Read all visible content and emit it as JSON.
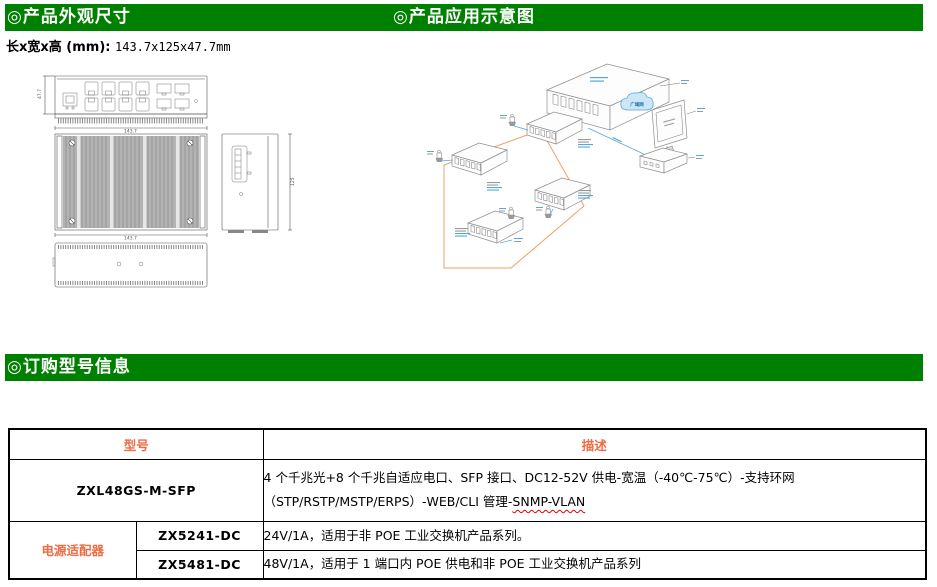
{
  "sections": {
    "appearance_title": "◎产品外观尺寸",
    "application_title": "◎产品应用示意图",
    "ordering_title": "◎订购型号信息"
  },
  "colors": {
    "header_green": "#008000",
    "accent_orange": "#EC6C44",
    "diagram_blue": "#56A5DC",
    "diagram_orange": "#F0A068"
  },
  "dimensions_line": {
    "label": "长x宽x高 (mm): ",
    "value": "143.7x125x47.7mm"
  },
  "drawing": {
    "front_width": "143.7",
    "front_height": "47.7",
    "top_width": "143.7",
    "side_depth": "125"
  },
  "diagram": {
    "cloud_label": "广域网"
  },
  "ordering_table": {
    "col_model": "型号",
    "col_desc": "描述",
    "row1": {
      "model": "ZXL48GS-M-SFP",
      "desc_line1": "4 个千兆光+8 个千兆自适应电口、SFP 接口、DC12-52V 供电-宽温（-40℃-75℃）-支持环网",
      "desc_line2": "（STP/RSTP/MSTP/ERPS）-WEB/CLI 管理-",
      "desc_flagged": "SNMP-VLAN"
    },
    "adapter_group": "电源适配器",
    "row2": {
      "model": "ZX5241-DC",
      "desc": "24V/1A，适用于非 POE 工业交换机产品系列。"
    },
    "row3": {
      "model": "ZX5481-DC",
      "desc": "48V/1A，适用于 1 端口内 POE 供电和非 POE 工业交换机产品系列"
    }
  }
}
